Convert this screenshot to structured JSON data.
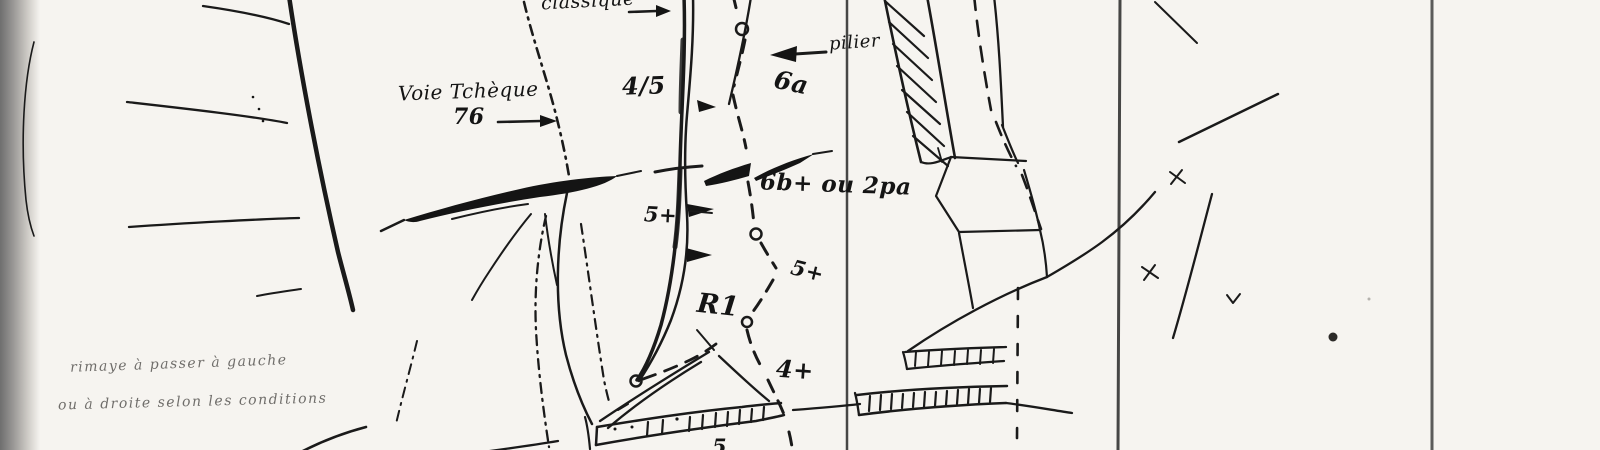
{
  "artwork": {
    "type": "hand-drawn climbing topo sketch (scanned)",
    "paper_color": "#f6f4f0",
    "ink_color": "#1a1a1a",
    "route_highlight_color": "#ad4663",
    "scan_edge_color": "#6e6e6e"
  },
  "labels": {
    "route_classique": "classique",
    "route_tcheque_name": "Voie Tchèque",
    "route_tcheque_year": "76",
    "feature_pilier": "pilier",
    "grade_4_5": "4/5",
    "grade_6a": "6a",
    "grade_6b_aid": "6b+ ou 2pa",
    "grade_5plus_upper": "5+",
    "grade_5plus_mid": "5+",
    "belay_r1": "R1",
    "grade_4plus": "4+",
    "grade_partial_bottom": "5",
    "note_line1": "rimaye à passer à gauche",
    "note_line2": "ou à droite selon les conditions"
  }
}
